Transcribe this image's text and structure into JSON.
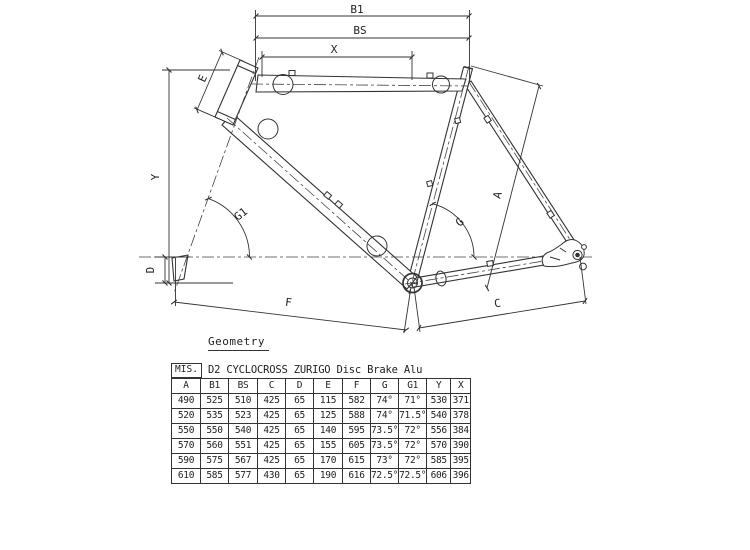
{
  "diagram": {
    "caption": "Geometry",
    "labels": {
      "b1": "B1",
      "bs": "BS",
      "x": "X",
      "e": "E",
      "y": "Y",
      "g1": "G1",
      "d": "D",
      "f": "F",
      "a": "A",
      "g": "G",
      "c": "C"
    }
  },
  "table": {
    "size_label": "MIS.",
    "title": "D2 CYCLOCROSS ZURIGO Disc Brake Alu",
    "columns": [
      "A",
      "B1",
      "BS",
      "C",
      "D",
      "E",
      "F",
      "G",
      "G1",
      "Y",
      "X"
    ],
    "rows": [
      [
        "490",
        "525",
        "510",
        "425",
        "65",
        "115",
        "582",
        "74°",
        "71°",
        "530",
        "371"
      ],
      [
        "520",
        "535",
        "523",
        "425",
        "65",
        "125",
        "588",
        "74°",
        "71.5°",
        "540",
        "378"
      ],
      [
        "550",
        "550",
        "540",
        "425",
        "65",
        "140",
        "595",
        "73.5°",
        "72°",
        "556",
        "384"
      ],
      [
        "570",
        "560",
        "551",
        "425",
        "65",
        "155",
        "605",
        "73.5°",
        "72°",
        "570",
        "390"
      ],
      [
        "590",
        "575",
        "567",
        "425",
        "65",
        "170",
        "615",
        "73°",
        "72°",
        "585",
        "395"
      ],
      [
        "610",
        "585",
        "577",
        "430",
        "65",
        "190",
        "616",
        "72.5°",
        "72.5°",
        "606",
        "396"
      ]
    ]
  },
  "colors": {
    "line": "#333333",
    "text": "#222222",
    "background": "#ffffff"
  }
}
